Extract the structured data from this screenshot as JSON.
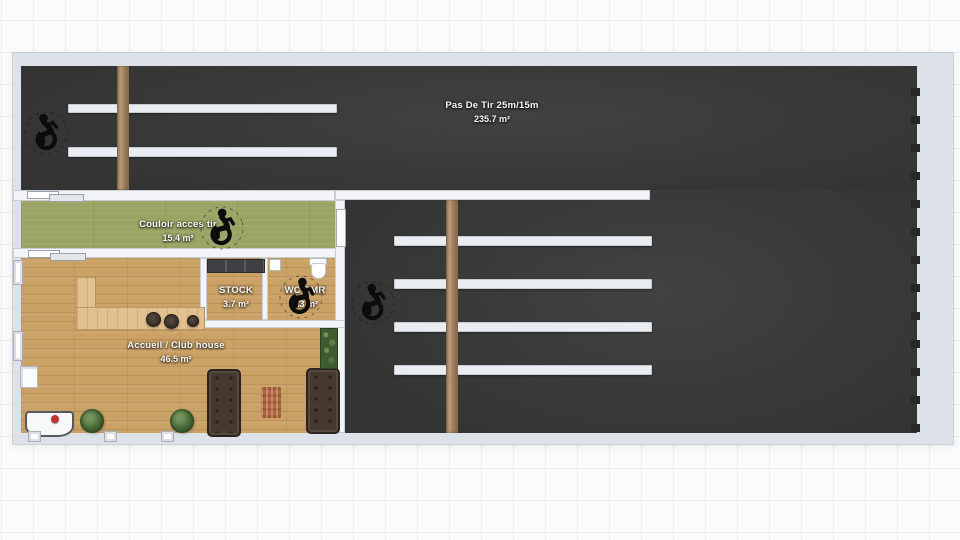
{
  "plan": {
    "title": "Floor plan",
    "rooms": {
      "range": {
        "label": "Pas De Tir 25m/15m",
        "area": "235.7 m²"
      },
      "corridor": {
        "label": "Couloir acces tir",
        "area": "15.4 m²"
      },
      "stock": {
        "label": "STOCK",
        "area": "3.7 m²"
      },
      "wc": {
        "label": "WC PMR",
        "area": "4.3 m²"
      },
      "clubhouse": {
        "label": "Accueil / Club house",
        "area": "46.5 m²"
      }
    },
    "colors": {
      "range_floor": "#3a3a3a",
      "corridor_floor": "#9aa464",
      "wood_floor": "#cba266",
      "wall": "#f2f4f7",
      "outer_band": "#d8dee6",
      "shooting_table": "#e9edf2",
      "wood_post": "#a3835f",
      "accent_red": "#c23030"
    },
    "icons": {
      "accessibility": "wheelchair"
    }
  }
}
